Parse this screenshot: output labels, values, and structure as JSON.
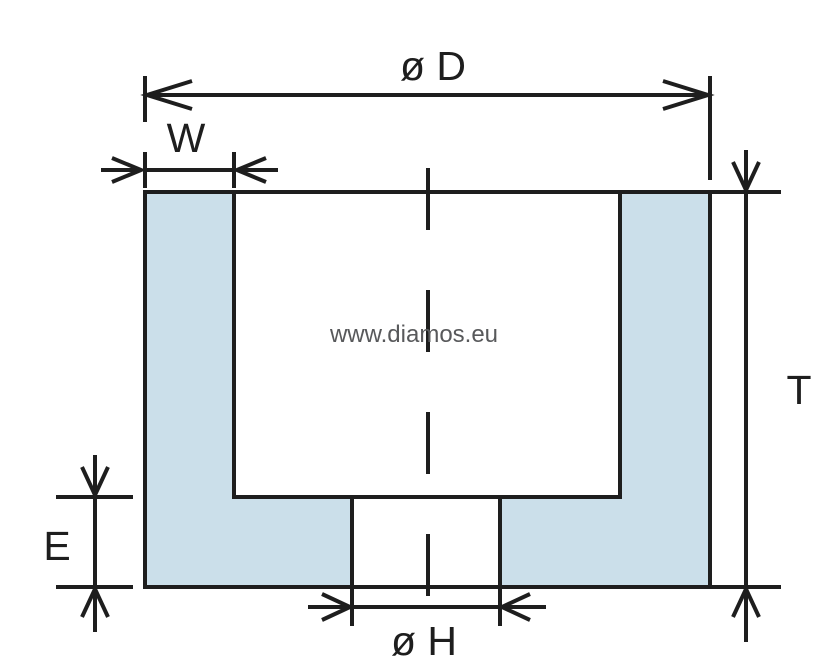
{
  "diagram": {
    "watermark": "www.diamos.eu",
    "dimensions": {
      "outer_diameter": {
        "label": "ø D"
      },
      "rim_width": {
        "label": "W"
      },
      "height": {
        "label": "T"
      },
      "base_thickness": {
        "label": "E"
      },
      "bore_diameter": {
        "label": "ø H"
      }
    },
    "colors": {
      "background": "#ffffff",
      "fill": "#cbdfea",
      "line": "#1e1e1e",
      "watermark": "#58595b"
    }
  }
}
